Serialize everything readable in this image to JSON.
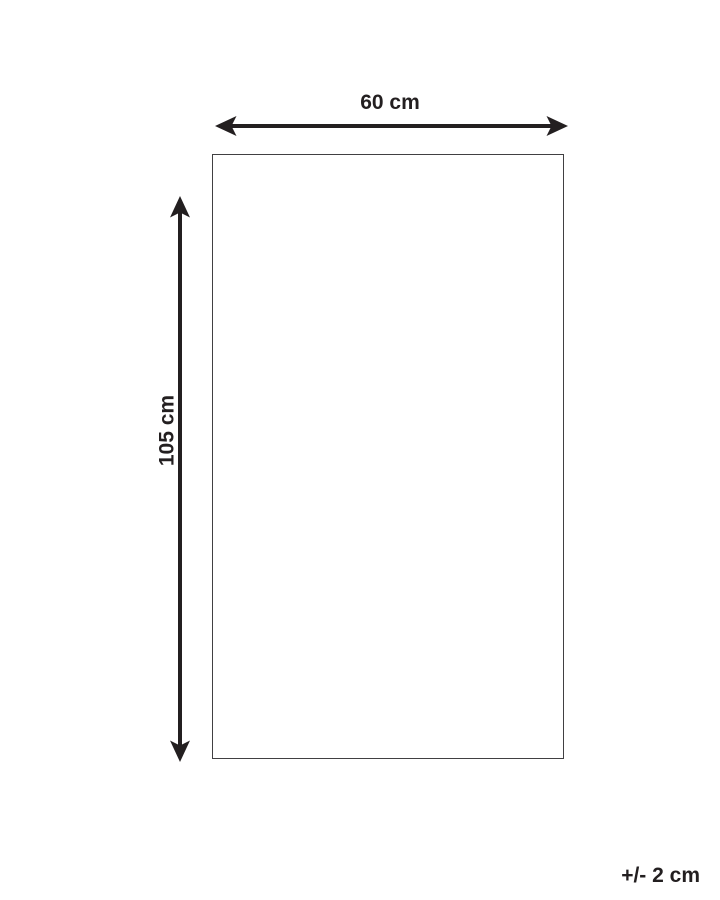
{
  "diagram": {
    "width_label": "60 cm",
    "height_label": "105 cm",
    "tolerance_label": "+/- 2 cm"
  },
  "colors": {
    "line": "#231f20",
    "border": "#414042",
    "background": "#ffffff"
  }
}
